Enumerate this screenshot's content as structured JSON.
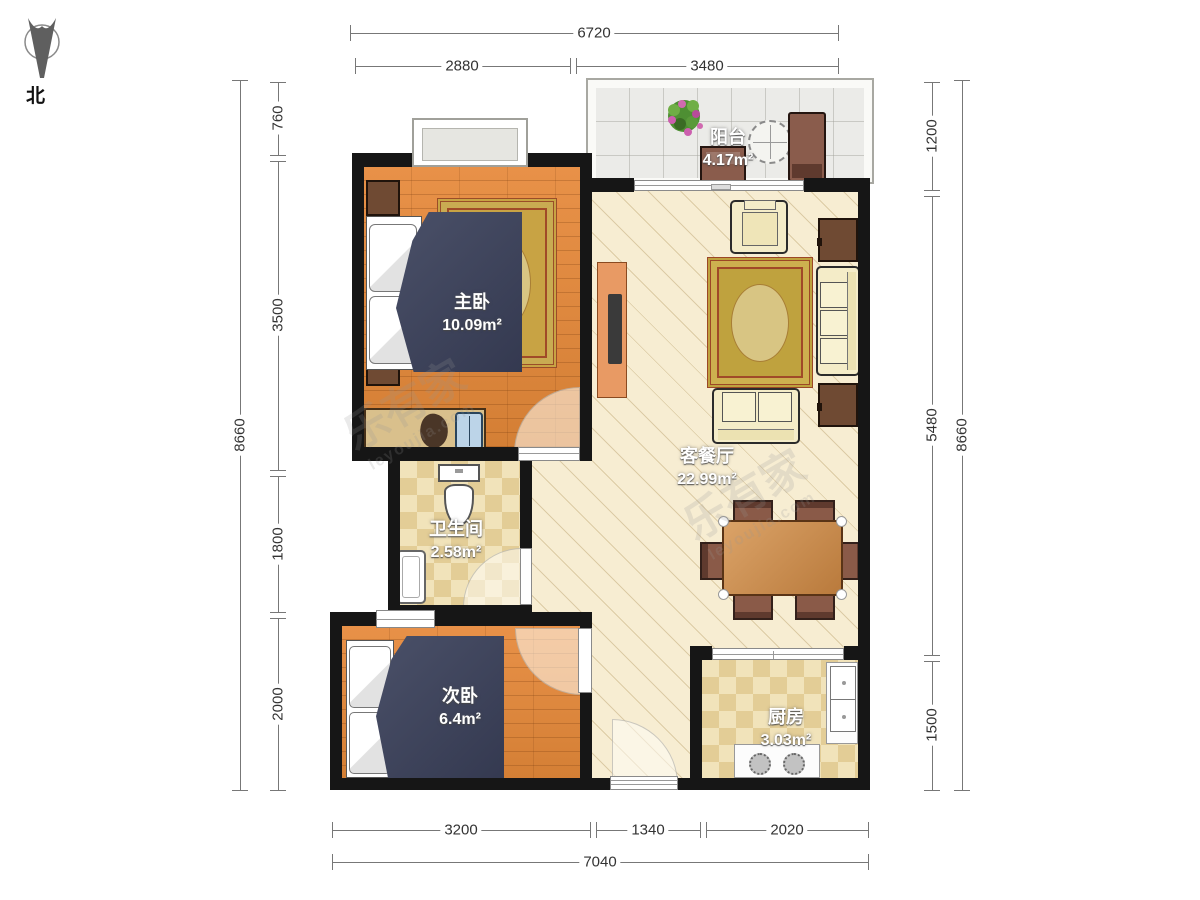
{
  "compass": {
    "label": "北"
  },
  "watermark": {
    "brand": "乐有家",
    "domain": "leyoujia.com"
  },
  "rooms": {
    "master": {
      "name": "主卧",
      "area": "10.09m²"
    },
    "balcony": {
      "name": "阳台",
      "area": "4.17m²"
    },
    "living": {
      "name": "客餐厅",
      "area": "22.99m²"
    },
    "bath": {
      "name": "卫生间",
      "area": "2.58m²"
    },
    "second": {
      "name": "次卧",
      "area": "6.4m²"
    },
    "kitchen": {
      "name": "厨房",
      "area": "3.03m²"
    }
  },
  "dims": {
    "top": {
      "total": "6720",
      "segs": [
        "2880",
        "3480"
      ]
    },
    "bottom": {
      "total": "7040",
      "segs": [
        "3200",
        "1340",
        "2020"
      ]
    },
    "left": {
      "total": "8660",
      "segs": [
        "760",
        "3500",
        "1800",
        "2000"
      ]
    },
    "right": {
      "total": "8660",
      "segs": [
        "1200",
        "5480",
        "1500"
      ]
    }
  }
}
